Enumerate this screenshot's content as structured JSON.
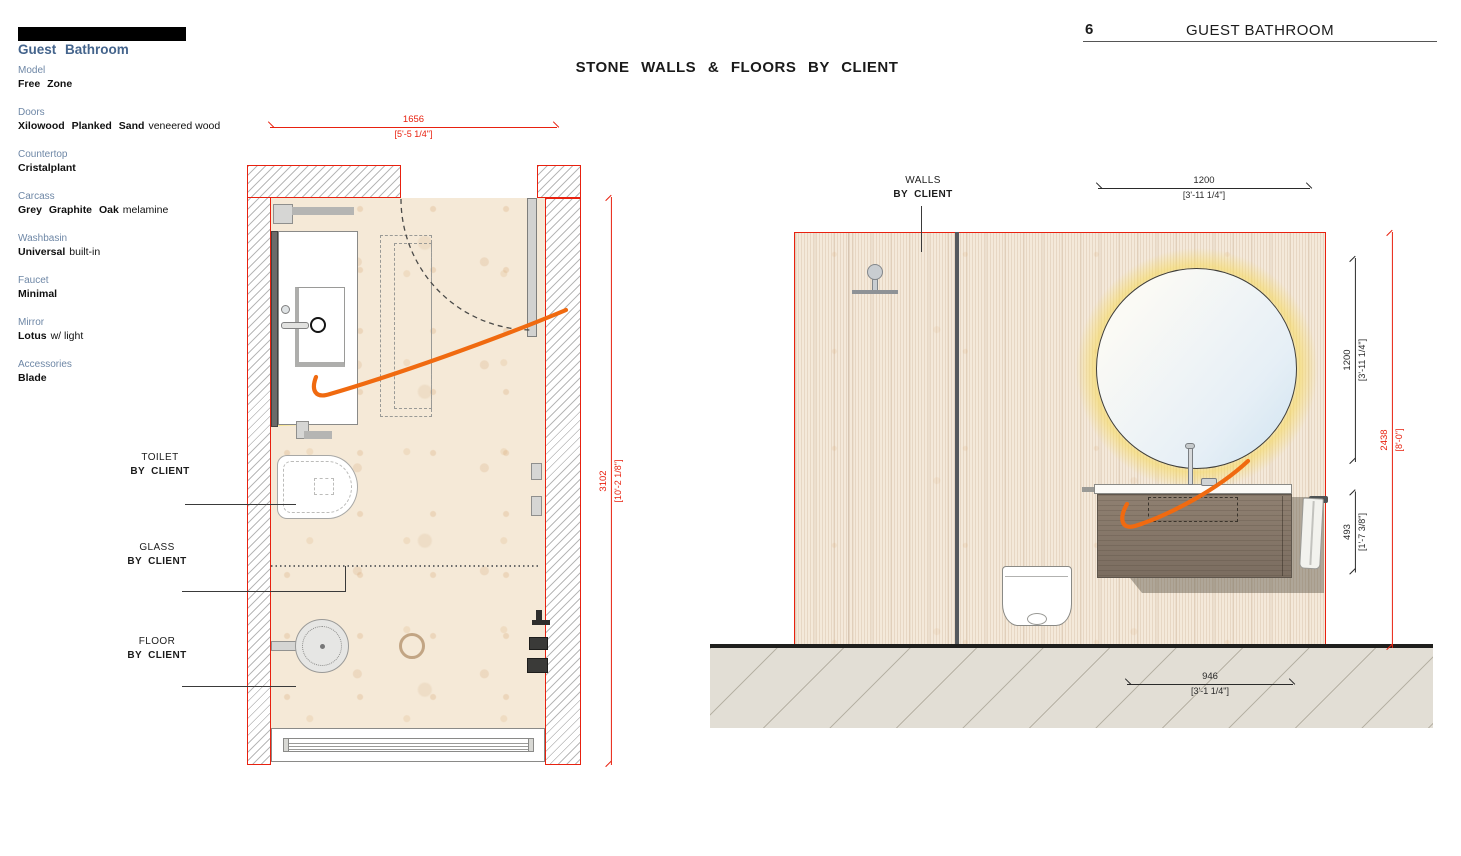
{
  "meta": {
    "page_number": "6",
    "page_title": "GUEST BATHROOM"
  },
  "drawing_title": "STONE WALLS & FLOORS BY CLIENT",
  "spec_panel": {
    "title": "Guest Bathroom",
    "items": [
      {
        "label": "Model",
        "value": "Free Zone",
        "suffix": ""
      },
      {
        "label": "Doors",
        "value": "Xilowood Planked Sand",
        "suffix": "veneered wood"
      },
      {
        "label": "Countertop",
        "value": "Cristalplant",
        "suffix": ""
      },
      {
        "label": "Carcass",
        "value": "Grey Graphite Oak",
        "suffix": "melamine"
      },
      {
        "label": "Washbasin",
        "value": "Universal",
        "suffix": "built-in"
      },
      {
        "label": "Faucet",
        "value": "Minimal",
        "suffix": ""
      },
      {
        "label": "Mirror",
        "value": "Lotus",
        "suffix": "w/ light"
      },
      {
        "label": "Accessories",
        "value": "Blade",
        "suffix": ""
      }
    ]
  },
  "plan": {
    "dim_width": {
      "mm": "1656",
      "imperial": "[5'-5 1/4\"]"
    },
    "dim_height": {
      "mm": "3102",
      "imperial": "[10'-2 1/8\"]"
    },
    "callouts": [
      {
        "line1": "TOILET",
        "line2": "BY CLIENT"
      },
      {
        "line1": "GLASS",
        "line2": "BY CLIENT"
      },
      {
        "line1": "FLOOR",
        "line2": "BY CLIENT"
      }
    ]
  },
  "elevation": {
    "callout": {
      "line1": "WALLS",
      "line2": "BY CLIENT"
    },
    "dim_mirror_width": {
      "mm": "1200",
      "imperial": "[3'-11 1/4\"]"
    },
    "dim_mirror_height": {
      "mm": "1200",
      "imperial": "[3'-11 1/4\"]"
    },
    "dim_vanity_height": {
      "mm": "493",
      "imperial": "[1'-7 3/8\"]"
    },
    "dim_wall_height": {
      "mm": "2438",
      "imperial": "[8'-0\"]"
    },
    "dim_vanity_width": {
      "mm": "946",
      "imperial": "[3'-1 1/4\"]"
    }
  },
  "colors": {
    "accent_red": "#e8210f",
    "spec_title_blue": "#44648c",
    "spec_label_blue": "#6e87a6",
    "swoosh_orange": "#f06a10",
    "mirror_glow_yellow": "#f3dc86"
  }
}
